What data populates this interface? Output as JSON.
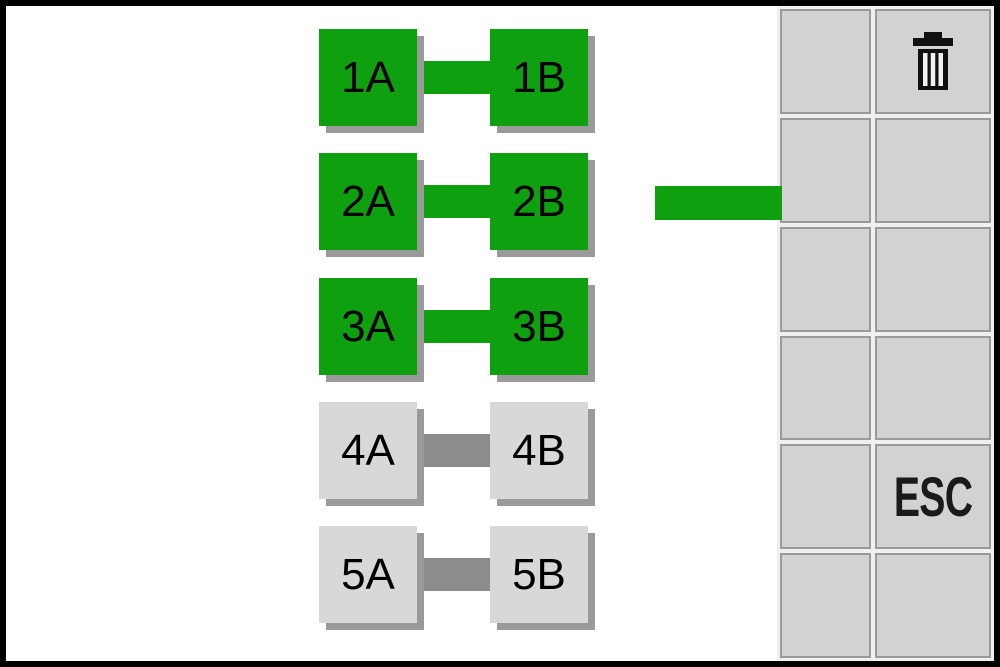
{
  "board": {
    "pairs": [
      {
        "left_label": "1A",
        "right_label": "1B",
        "status": "connected"
      },
      {
        "left_label": "2A",
        "right_label": "2B",
        "status": "connected"
      },
      {
        "left_label": "3A",
        "right_label": "3B",
        "status": "connected"
      },
      {
        "left_label": "4A",
        "right_label": "4B",
        "status": "inactive"
      },
      {
        "left_label": "5A",
        "right_label": "5B",
        "status": "inactive"
      }
    ],
    "loose_connector": {
      "present": true,
      "color": "#0FA00F"
    }
  },
  "side_panel": {
    "grid_rows": 6,
    "grid_cols": 2,
    "trash_icon": "trash-icon",
    "esc_label": "ESC"
  },
  "colors": {
    "active_green": "#0FA00F",
    "inactive_block": "#D8D8D8",
    "inactive_connector": "#8C8C8C",
    "block_shadow": "#9A9A9A",
    "panel_cell_fill": "#D2D2D2",
    "panel_gap": "#F0F0F0",
    "cell_border": "#9A9A9A",
    "frame": "#000000",
    "background": "#FFFFFF",
    "label_text": "#000000"
  }
}
